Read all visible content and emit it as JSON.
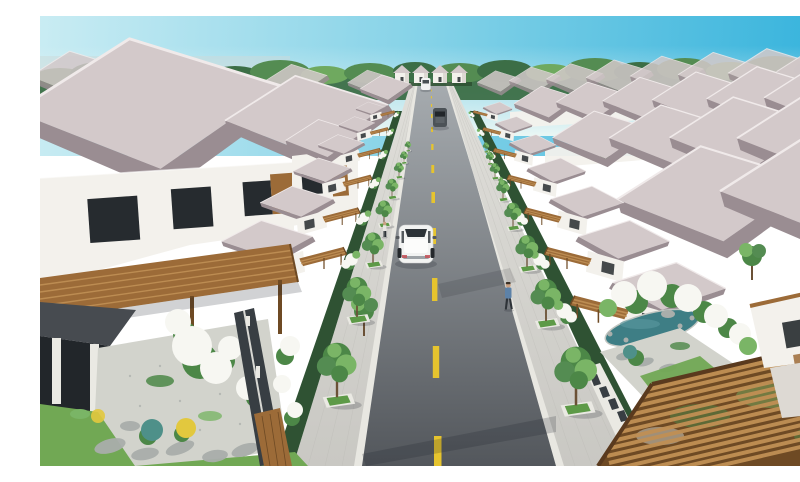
{
  "image": {
    "kind": "3d-architectural-rendering",
    "alt": "Aerial three-quarter view of a master-planned villa neighborhood: two mirrored rows of white two-story villas with mauve hipped tile roofs and timber carport pergolas flank a straight two-lane asphalt road with a dashed yellow center line that recedes to the horizon under a clear blue sky; street trees in white square planters line both sidewalks, a white SUV drives up the center with two cars ahead, two pedestrians walk the sidewalks, and foreground gardens show white flowering shrubs, a koi pond, gravel courtyards, stepping stones and slatted privacy fences.",
    "width_px": 800,
    "height_px": 450
  },
  "scene": {
    "setting": "planned residential villa community, aerial perspective down the central street",
    "sky": "clear, pale at left horizon, deeper azure at top right",
    "horizon": "continuous tree line behind the farthest row of houses",
    "road": {
      "lanes": 2,
      "surface": "asphalt",
      "marking": "dashed yellow center line",
      "end": "row of small identical gabled houses across the far end"
    },
    "vehicles": [
      {
        "type": "white SUV",
        "view": "rear",
        "position": "center of road, foreground"
      },
      {
        "type": "dark gray car",
        "position": "mid distance"
      },
      {
        "type": "white car",
        "position": "far distance near road end"
      }
    ],
    "pedestrians": [
      {
        "position": "left sidewalk, mid distance",
        "clothing": "light shirt, dark pants"
      },
      {
        "position": "right sidewalk, foreground",
        "clothing": "blue shirt, dark pants"
      }
    ],
    "streetscape": [
      "street trees in white square planters with grass",
      "gray paver sidewalks",
      "clipped dark hedges along property lines",
      "white flowering trees at each villa frontage"
    ],
    "architecture": [
      "two-story white villas",
      "hipped mauve-gray tile roofs",
      "brown timber carport pergolas facing the street",
      "dark slatted fences with white caps",
      "wooden gates"
    ],
    "gardens": [
      "white flowering shrubs",
      "yellow and teal flower beds",
      "teal koi pond with rock feature",
      "gravel courtyards with stepping stones",
      "lawns"
    ]
  },
  "palette": {
    "sky_left": "#c9ecf3",
    "sky_mid": "#82d1e7",
    "sky_right": "#33b2dc",
    "sky_horizon": "#eef8f5",
    "haze_band": "#ccd9d9",
    "tree_dark": "#3c6e46",
    "tree_mid": "#548c52",
    "tree_light": "#6fa95f",
    "roof_light": "#d3c9ca",
    "roof_shade": "#9a8d92",
    "roof_ridge": "#f0eaea",
    "wall_white": "#f3f1ec",
    "wall_shade": "#ddd9d3",
    "window_dark": "#262b2f",
    "wood": "#9c6b38",
    "wood_light": "#c09055",
    "wood_dark": "#6e4a24",
    "road_near": "#53575c",
    "road_far": "#a8adb1",
    "lane_yellow": "#e6c42e",
    "sidewalk_near": "#c9c8c3",
    "sidewalk_far": "#e0dfda",
    "curb": "#e8e7e1",
    "hedge": "#2f5233",
    "lawn": "#71a854",
    "planter_grass": "#5d9a47",
    "foliage": "#4c8747",
    "foliage_light": "#7ab566",
    "flower_white": "#f7f7f2",
    "flower_yellow": "#e2c83e",
    "flower_teal": "#4e9089",
    "pond": "#3e7e85",
    "gravel": "#d2d3cc",
    "stone": "#a9aeab",
    "fence_dark": "#383e43",
    "fence_light": "#eae9e3",
    "car_white": "#f2f3f2",
    "car_dark": "#4c5257",
    "car_glass": "#2c3237",
    "trunk": "#6b5136",
    "skin": "#c9a183",
    "shirt_blue": "#5d82a8",
    "pants_dark": "#2e3338",
    "porch_dark": "#474b50",
    "interior_dark": "#22262a",
    "shadow": "rgba(25,30,38,0.20)"
  }
}
